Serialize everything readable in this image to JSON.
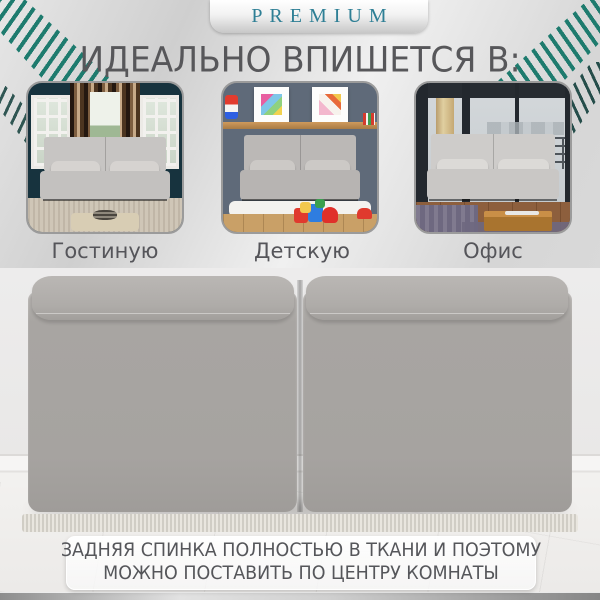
{
  "badge": {
    "label": "PREMIUM"
  },
  "heading": "ИДЕАЛЬНО ВПИШЕТСЯ В:",
  "rooms": [
    {
      "caption": "Гостиную"
    },
    {
      "caption": "Детскую комнату"
    },
    {
      "caption": "Офис"
    }
  ],
  "note": {
    "line1": "ЗАДНЯЯ СПИНКА ПОЛНОСТЬЮ В ТКАНИ И ПОЭТОМУ",
    "line2": "МОЖНО ПОСТАВИТЬ ПО ЦЕНТРУ КОМНАТЫ"
  },
  "colors": {
    "palm_teal": "#1E7B6E",
    "palm_dark": "#123F3B",
    "premium_text": "#2E7F95",
    "text_dark": "#57575A",
    "sofa_gray": "#A8A5A2"
  }
}
